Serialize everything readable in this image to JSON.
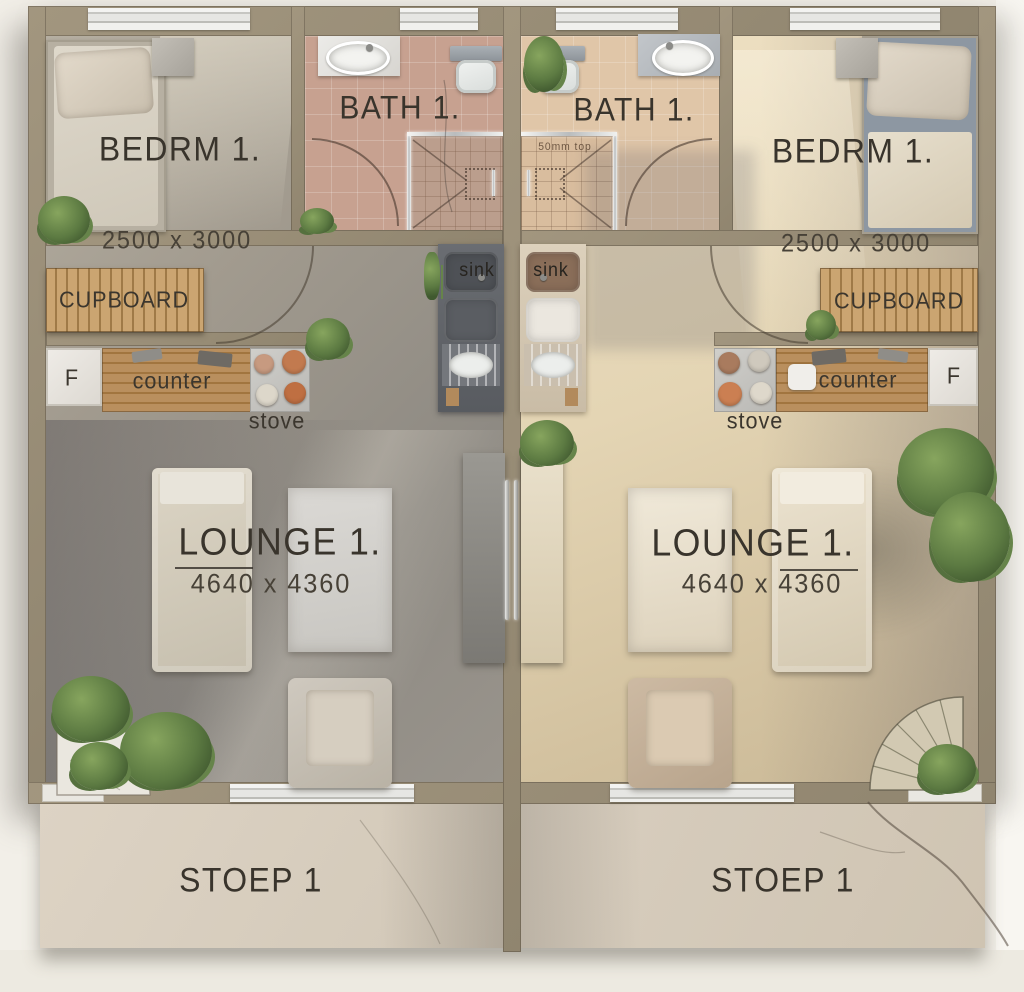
{
  "palette": {
    "wall": "#988d78",
    "floor_left_unit": "#a19a8e",
    "floor_right_unit": "#e4d5b4",
    "bath_tile_left": "#c7a190",
    "bath_tile_right": "#e0c6a8",
    "stoep_concrete": "#d7cdbe",
    "cupboard_wood": "#b98f5e",
    "label_ink": "#39342c",
    "plant_green": "#5c7a42",
    "bed_right_fabric": "#8d97a2"
  },
  "units": [
    {
      "side": "left",
      "bedroom": {
        "label": "BEDRM 1.",
        "dims": "2500 x 3000"
      },
      "bath": {
        "label": "BATH 1."
      },
      "kitchen": {
        "cupboard": "CUPBOARD",
        "fridge": "F",
        "counter": "counter",
        "stove": "stove",
        "sink": "sink"
      },
      "lounge": {
        "label": "LOUNGE 1.",
        "dims": "4640 x 4360"
      },
      "stoep": {
        "label": "STOEP 1"
      }
    },
    {
      "side": "right",
      "bedroom": {
        "label": "BEDRM 1.",
        "dims": "2500 x 3000"
      },
      "bath": {
        "label": "BATH 1.",
        "shower_note": "50mm top"
      },
      "kitchen": {
        "cupboard": "CUPBOARD",
        "fridge": "F",
        "counter": "counter",
        "stove": "stove",
        "sink": "sink"
      },
      "lounge": {
        "label": "LOUNGE 1.",
        "dims": "4640 x 4360"
      },
      "stoep": {
        "label": "STOEP 1"
      }
    }
  ]
}
